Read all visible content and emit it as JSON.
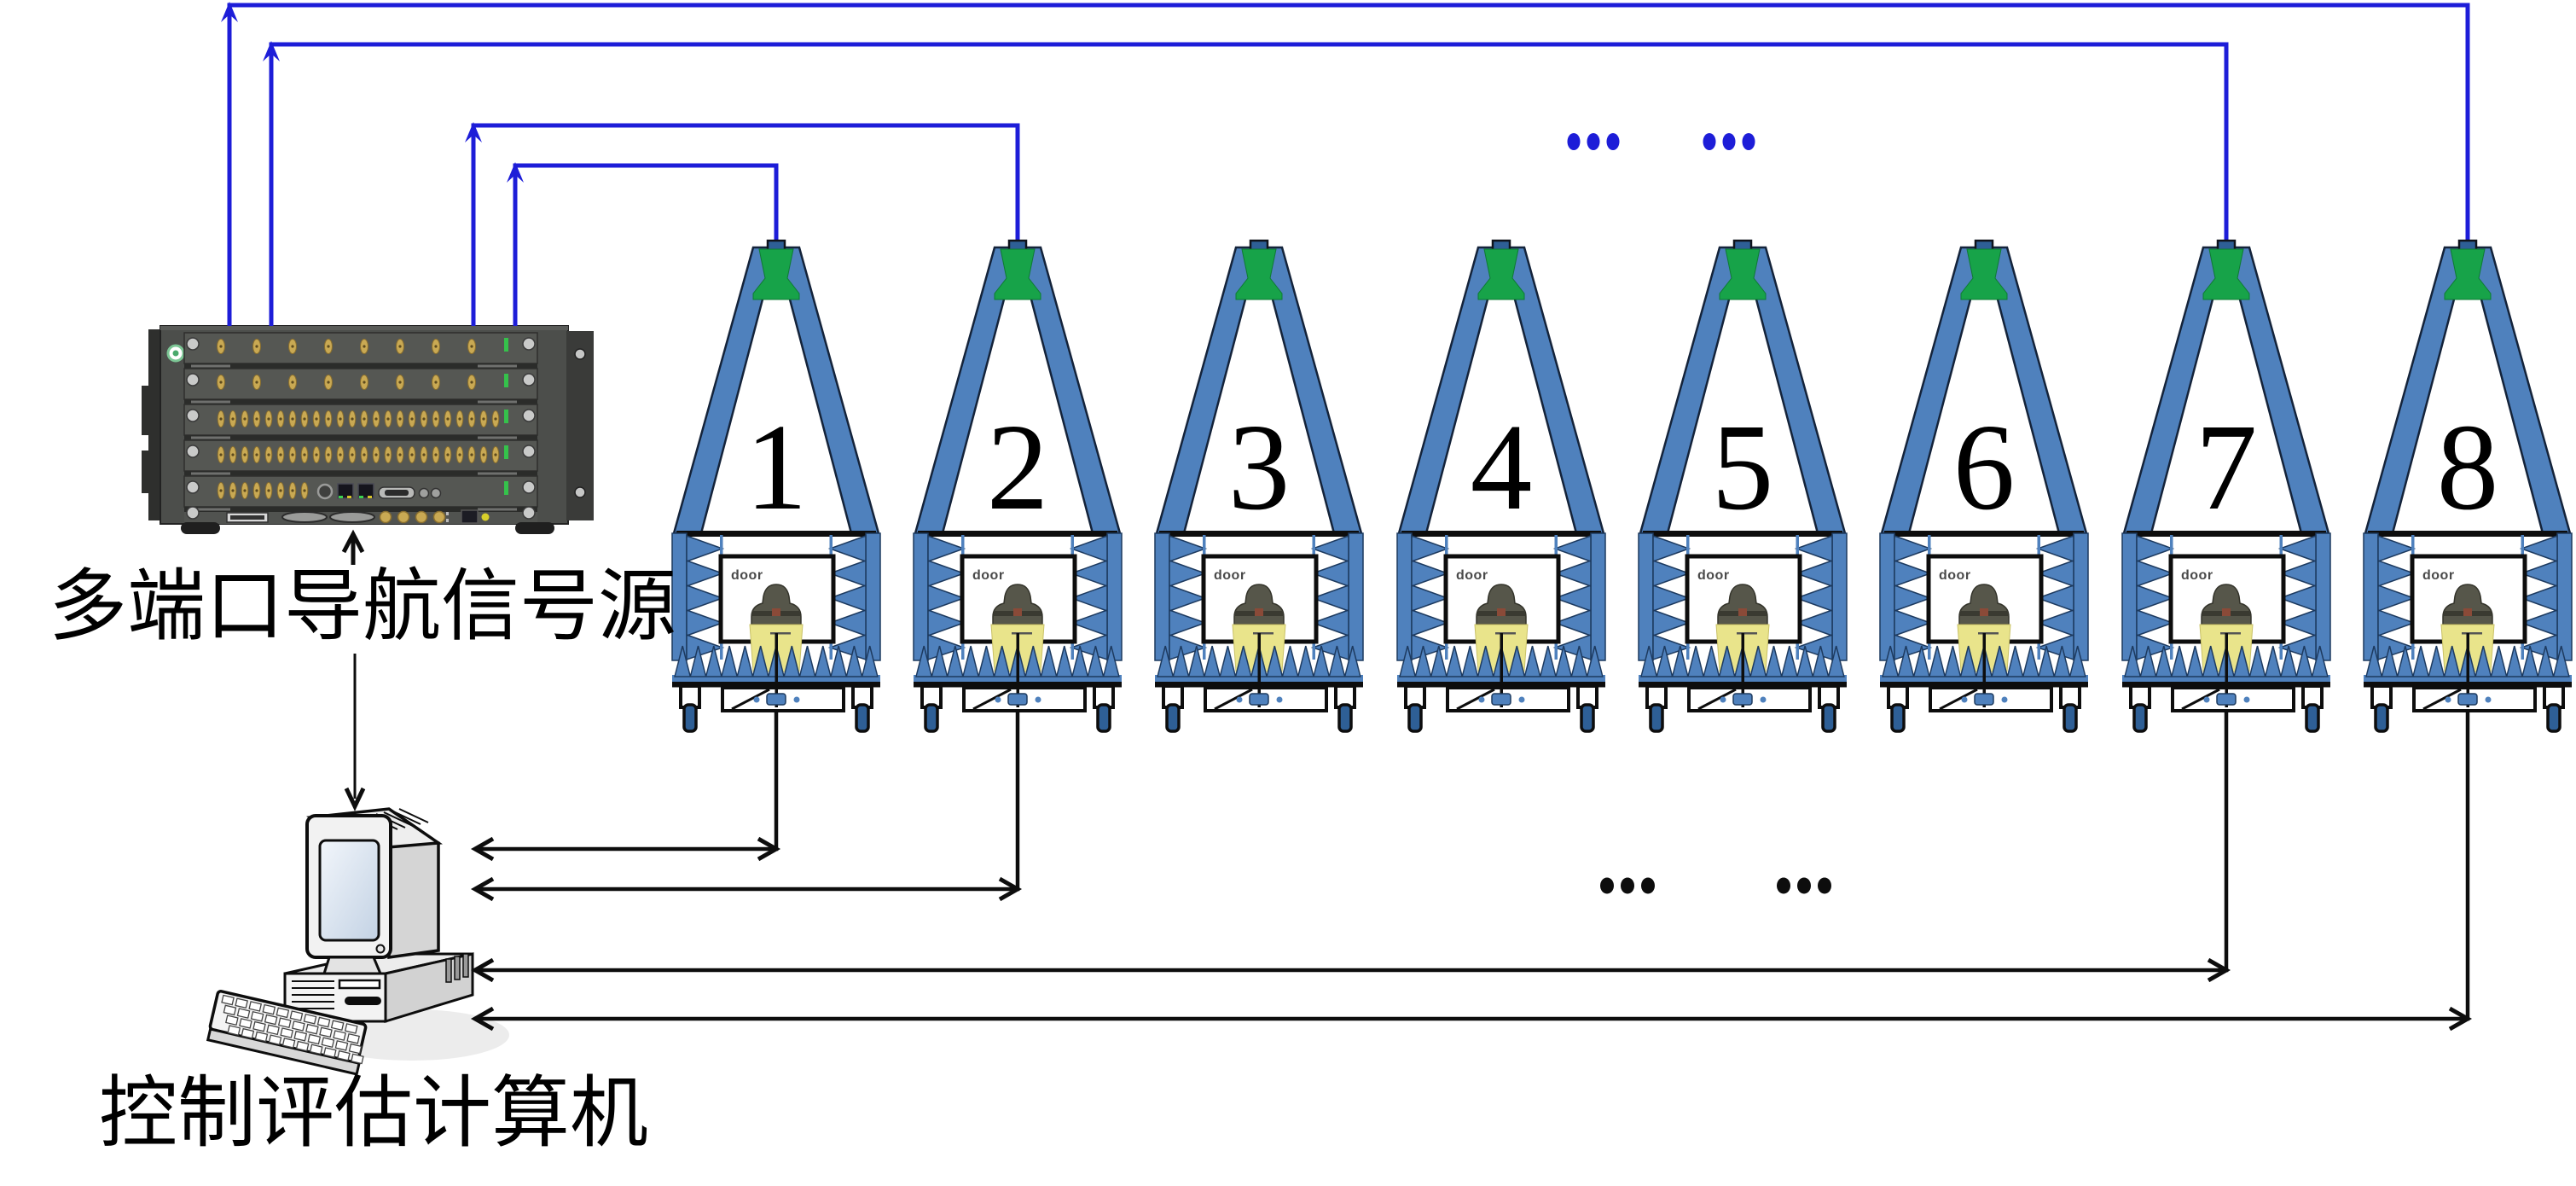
{
  "diagram": {
    "signal_source_label": "多端口导航信号源",
    "computer_label": "控制评估计算机",
    "door_label": "door",
    "ellipsis": "...",
    "chambers": [
      {
        "number": "1"
      },
      {
        "number": "2"
      },
      {
        "number": "3"
      },
      {
        "number": "4"
      },
      {
        "number": "5"
      },
      {
        "number": "6"
      },
      {
        "number": "7"
      },
      {
        "number": "8"
      }
    ],
    "colors": {
      "cable_blue": "#1d1dd8",
      "chamber_blue": "#4f81bd",
      "wheel_blue": "#2e5f96",
      "antenna_green": "#17a349",
      "device_yellow": "#e9e48b",
      "dome_gray": "#56564a",
      "rack_body": "#4c4e4b",
      "connector_gold": "#c9a953",
      "led_green": "#35c24b",
      "ink": "#0d0d0d"
    }
  }
}
